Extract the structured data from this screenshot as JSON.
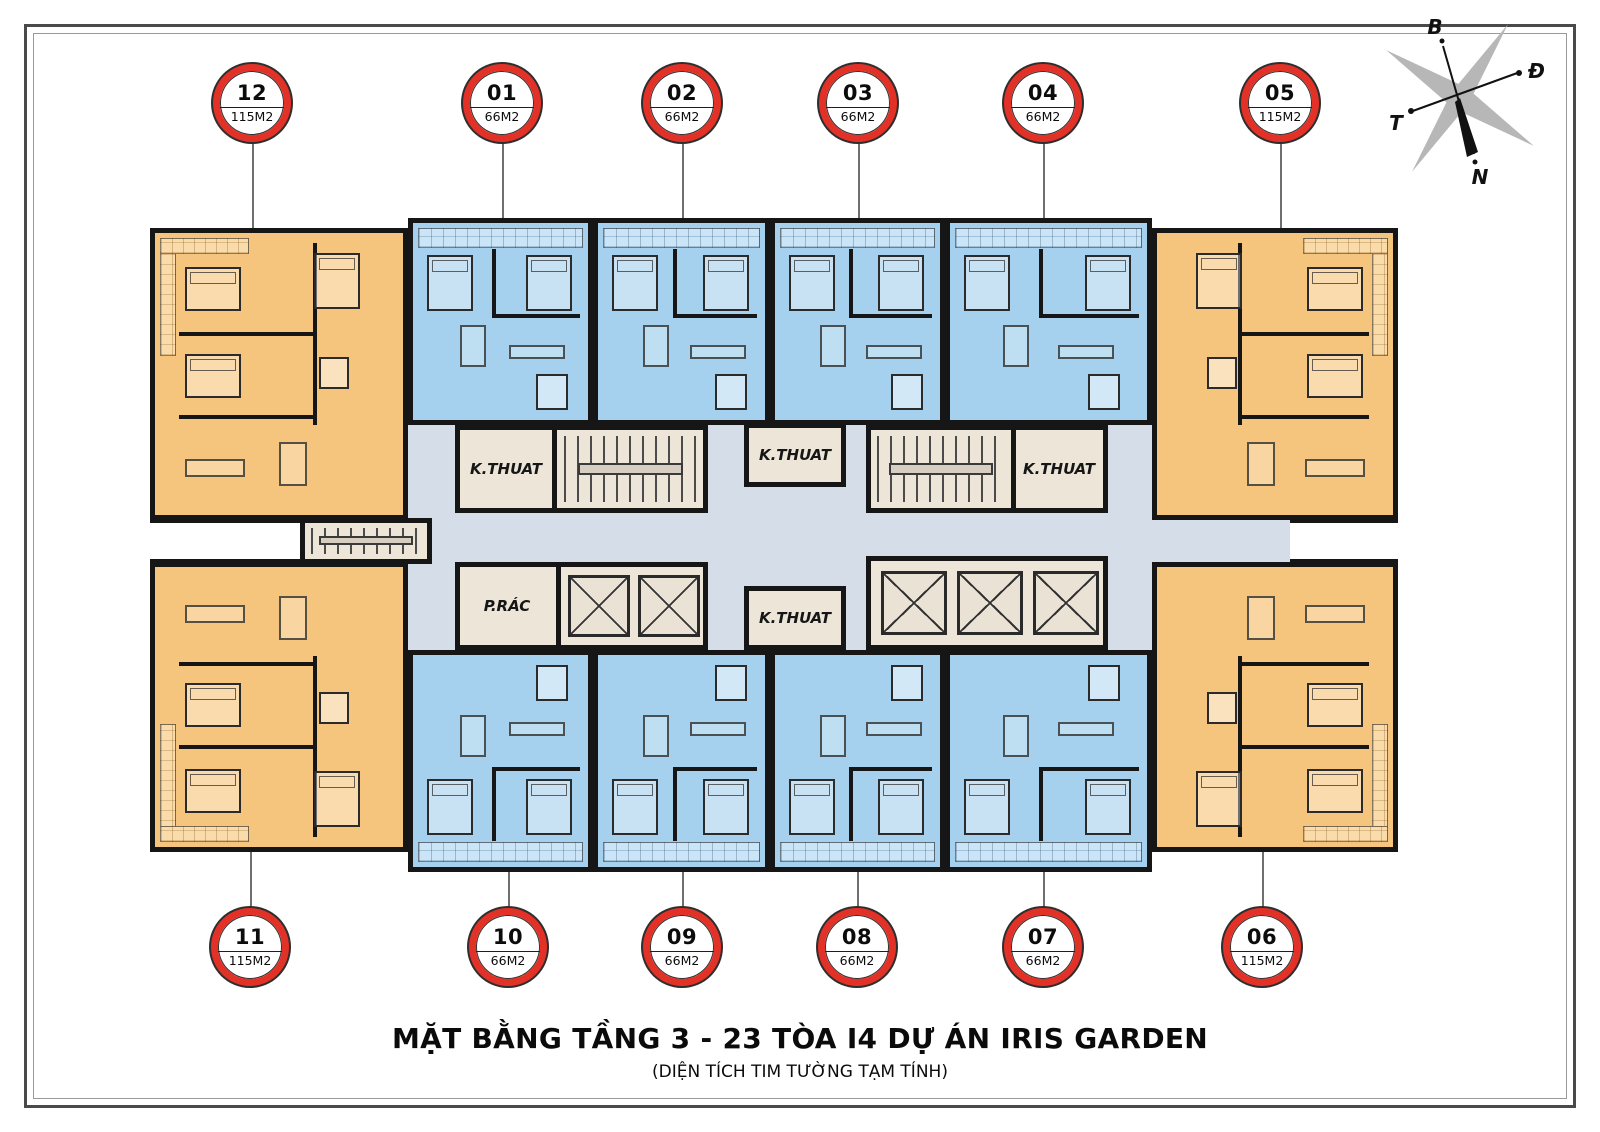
{
  "page": {
    "title": "MẶT BẰNG TẦNG 3 - 23 TÒA I4 DỰ ÁN IRIS GARDEN",
    "subtitle": "(DIỆN TÍCH TIM TƯỜNG TẠM TÍNH)"
  },
  "compass": {
    "north": "B",
    "east": "Đ",
    "west": "T",
    "south": "N"
  },
  "colors": {
    "badge_ring": "#e23127",
    "wall": "#161616",
    "unit_66m2_fill": "#a6d1ee",
    "unit_66m2_light": "#c9e5f7",
    "unit_115m2_fill": "#f6c57d",
    "unit_115m2_light": "#fadcab",
    "corridor_fill": "#d5dee8",
    "core_fill": "#ece5d8"
  },
  "units": [
    {
      "number": "12",
      "area": "115M2"
    },
    {
      "number": "01",
      "area": "66M2"
    },
    {
      "number": "02",
      "area": "66M2"
    },
    {
      "number": "03",
      "area": "66M2"
    },
    {
      "number": "04",
      "area": "66M2"
    },
    {
      "number": "05",
      "area": "115M2"
    },
    {
      "number": "11",
      "area": "115M2"
    },
    {
      "number": "10",
      "area": "66M2"
    },
    {
      "number": "09",
      "area": "66M2"
    },
    {
      "number": "08",
      "area": "66M2"
    },
    {
      "number": "07",
      "area": "66M2"
    },
    {
      "number": "06",
      "area": "115M2"
    }
  ],
  "core_rooms": [
    {
      "id": "k-thuat-top-left",
      "label": "K.THUAT"
    },
    {
      "id": "k-thuat-top-center",
      "label": "K.THUAT"
    },
    {
      "id": "k-thuat-top-right",
      "label": "K.THUAT"
    },
    {
      "id": "k-thuat-bottom-center",
      "label": "K.THUAT"
    },
    {
      "id": "p-rac-bottom-left",
      "label": "P.RÁC"
    }
  ]
}
